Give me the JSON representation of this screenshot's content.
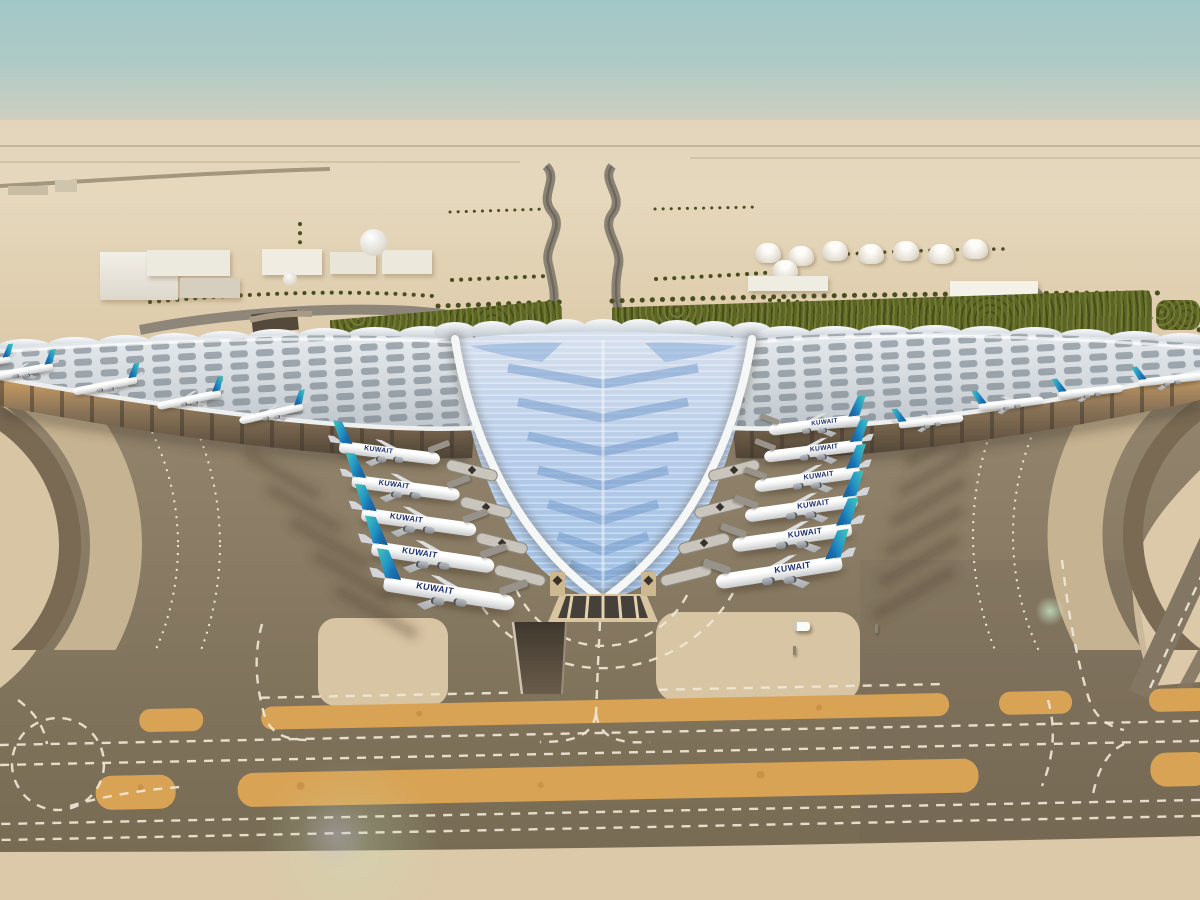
{
  "scene": {
    "type": "aerial architectural rendering",
    "setting": "desert airport under a hazy teal sky",
    "landmark": "trident-shaped terminal with a swooping blue glazed roof and silver concourse wings",
    "airline_wordmark": "KUWAIT",
    "tail_livery": "teal-to-blue gradient fin",
    "counts": {
      "left_concourse_aircraft": 5,
      "right_concourse_aircraft": 6,
      "left_wing_aircraft": 5,
      "right_wing_aircraft": 4,
      "fuel_tanks": 8,
      "warehouse_buildings": 6,
      "dome_buildings": 2
    },
    "colors": {
      "sky_top": "#a2c7c7",
      "sky_horizon": "#e0d5bf",
      "desert": "#e2d2b5",
      "foreground_sand": "#dcc9a9",
      "apron_concrete": "#8b7d67",
      "taxiway_asphalt": "#7c705a",
      "taxiway_shoulder_orange": "#d9a355",
      "marking_white": "#efe7d5",
      "roof_silver": "#dde2e6",
      "roof_glazing_blue": "#aac6e5",
      "roof_edge_white": "#f4f6f6",
      "canopy_soffit_amber": "#a8875d",
      "greenery": "#5d6526",
      "tail_teal": "#43c6ba",
      "tail_blue": "#1a6fb0",
      "wordmark_navy": "#1d2f6f"
    }
  }
}
